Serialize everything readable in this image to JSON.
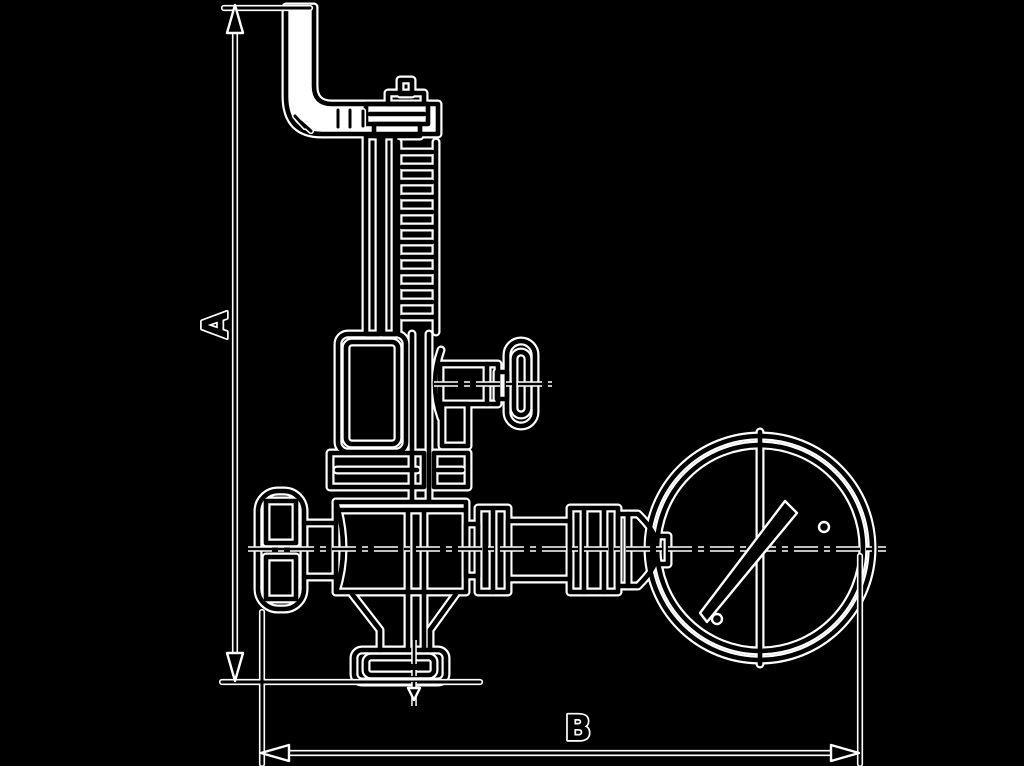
{
  "page": {
    "background_color": "#000000"
  },
  "drawing": {
    "kind": "technical dimensional line drawing",
    "subject": "safety relief valve with exhaust elbow pipe, side test handle, handwheel, bottom outlet flange and pressure gauge",
    "halo_color": "#ffffff",
    "ink_color": "#000000",
    "labels": {
      "dim_a": "A",
      "dim_b": "B"
    },
    "dimension_lines": [
      {
        "label": "A",
        "orientation": "vertical",
        "measures": "overall height of valve assembly"
      },
      {
        "label": "B",
        "orientation": "horizontal",
        "measures": "overall width from handwheel to gauge"
      }
    ],
    "components": [
      "exhaust elbow pipe",
      "adjusting screw and lock nut",
      "spring tube",
      "spring coils",
      "spring bonnet",
      "test valve tee handle",
      "bonnet flange",
      "valve body",
      "side handwheel",
      "outlet funnel",
      "bottom outlet flange",
      "gauge connection piping",
      "pressure gauge",
      "gauge needle"
    ]
  }
}
